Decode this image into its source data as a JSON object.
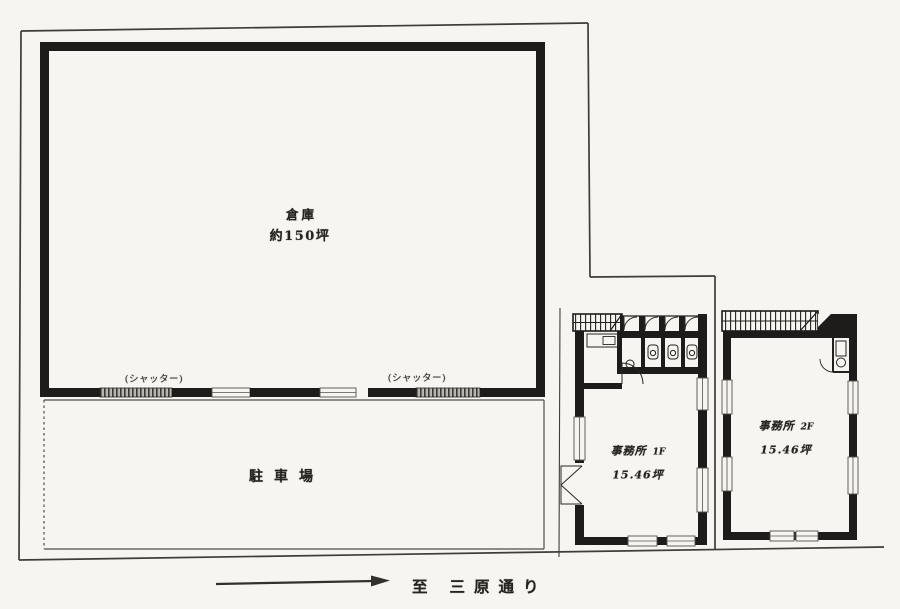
{
  "document": {
    "type": "site-floor-plan",
    "locale": "ja"
  },
  "warehouse": {
    "name": "倉庫",
    "area": "約150坪"
  },
  "parking": {
    "name": "駐車場"
  },
  "shutters": {
    "left": "(シャッター)",
    "right": "(シャッター)"
  },
  "offices": {
    "f1": {
      "name": "事務所",
      "floor": "1F",
      "area": "15.46坪"
    },
    "f2": {
      "name": "事務所",
      "floor": "2F",
      "area": "15.46坪"
    }
  },
  "street": {
    "to": "至",
    "name": "三原通り"
  },
  "colors": {
    "paper": "#f6f5f1",
    "wall_ink": "#1d1c1a",
    "boundary_line": "#3f3d39",
    "text_ink": "#262420",
    "shutter_fill": "#b9b6b0"
  }
}
